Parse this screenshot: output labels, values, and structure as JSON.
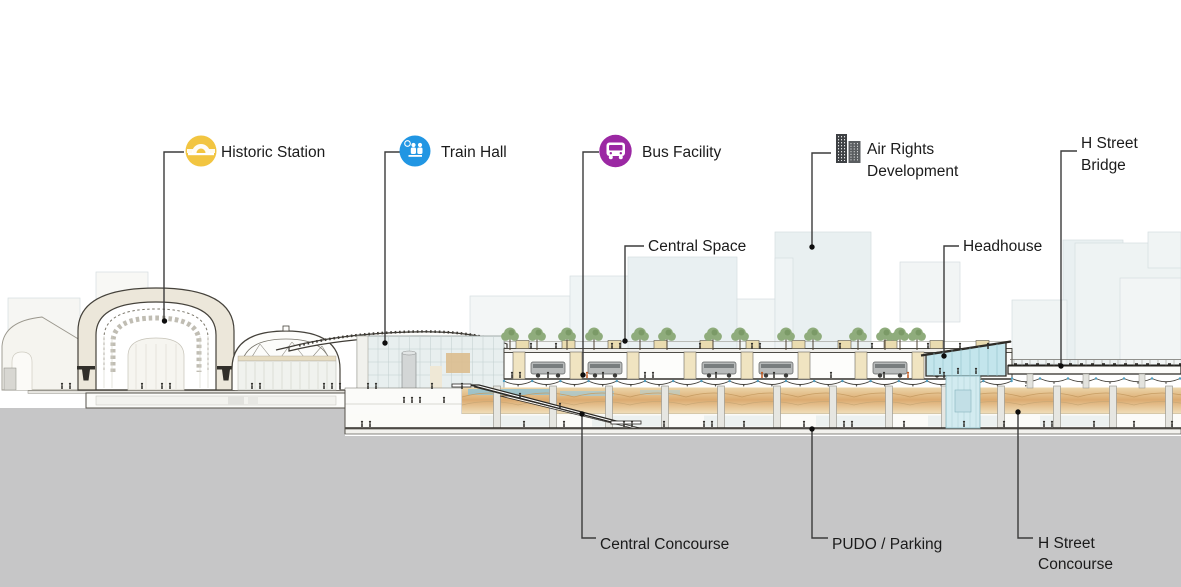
{
  "diagram": {
    "description": "Architectural cross-section diagram of a station expansion with labeled program elements",
    "callouts": {
      "historic_station": {
        "label": "Historic Station",
        "icon": "dome-icon"
      },
      "train_hall": {
        "label": "Train Hall",
        "icon": "train-hall-icon"
      },
      "bus_facility": {
        "label": "Bus Facility",
        "icon": "bus-icon"
      },
      "air_rights": {
        "line1": "Air Rights",
        "line2": "Development",
        "icon": "buildings-icon"
      },
      "h_street_bridge": {
        "line1": "H Street",
        "line2": "Bridge"
      },
      "central_space": {
        "label": "Central Space"
      },
      "headhouse": {
        "label": "Headhouse"
      },
      "central_concourse": {
        "label": "Central Concourse"
      },
      "pudo_parking": {
        "label": "PUDO / Parking"
      },
      "h_street_concourse": {
        "line1": "H Street",
        "line2": "Concourse"
      }
    },
    "colors": {
      "yellow": "#F2C541",
      "blue": "#2196E3",
      "purple": "#9B28A3",
      "icondark": "#3E4144",
      "leader": "#3b3b3b",
      "text": "#1b1b1b",
      "ground": "#C6C6C7",
      "cream": "#ECE7DA",
      "tan": "#EADCB0",
      "orange": "#DCA96D",
      "teal": "#C3E5EC",
      "massing": "#E9F0F2",
      "tree": "#8FAC7C"
    }
  }
}
